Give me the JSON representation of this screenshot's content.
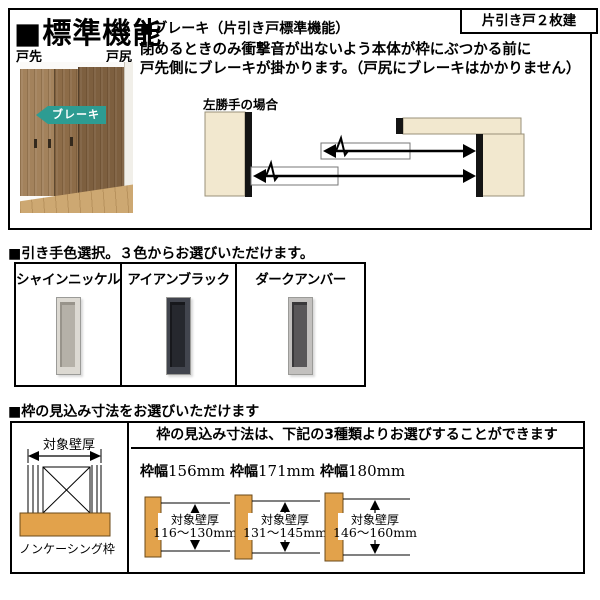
{
  "top": {
    "title": "■標準機能",
    "badge": "片引き戸２枚建",
    "brake": {
      "heading": "■ブレーキ（片引き戸標準機能）",
      "line1": "閉めるときのみ衝撃音が出ないよう本体が枠にぶつかる前に",
      "line2": "戸先側にブレーキが掛かります。（戸尻にブレーキはかかりません）"
    },
    "photo": {
      "label_front": "戸先",
      "label_rear": "戸尻",
      "arrow": "ブレーキ",
      "arrow_css": "background:#2d9c92"
    },
    "diagram": {
      "caption": "左勝手の場合",
      "wall_color": "#f2e8cf",
      "stop_color": "#141414"
    }
  },
  "handles": {
    "heading": "■引き手色選択。３色からお選びいただけます。",
    "options": [
      {
        "label": "シャインニッケル",
        "css": "--rim:#dcd9d2;--face:#b5b1a8;--edge:#98948b"
      },
      {
        "label": "アイアンブラック",
        "css": "--rim:#42454e;--face:#26282e;--edge:#17181c"
      },
      {
        "label": "ダークアンバー",
        "css": "--rim:#c2c0be;--face:#595759;--edge:#39383a"
      }
    ]
  },
  "frames": {
    "heading": "■枠の見込み寸法をお選びいただけます",
    "header": "枠の見込み寸法は、下記の3種類よりお選びすることができます",
    "wall_diagram": {
      "top_label": "対象壁厚",
      "bottom_label": "ノンケーシング枠",
      "frame_color": "#e2a24b"
    },
    "options": [
      {
        "width_prefix": "枠幅",
        "width_value": "156mm",
        "wall_label": "対象壁厚",
        "range": "116～130mm"
      },
      {
        "width_prefix": "枠幅",
        "width_value": "171mm",
        "wall_label": "対象壁厚",
        "range": "131～145mm"
      },
      {
        "width_prefix": "枠幅",
        "width_value": "180mm",
        "wall_label": "対象壁厚",
        "range": "146～160mm"
      }
    ]
  }
}
